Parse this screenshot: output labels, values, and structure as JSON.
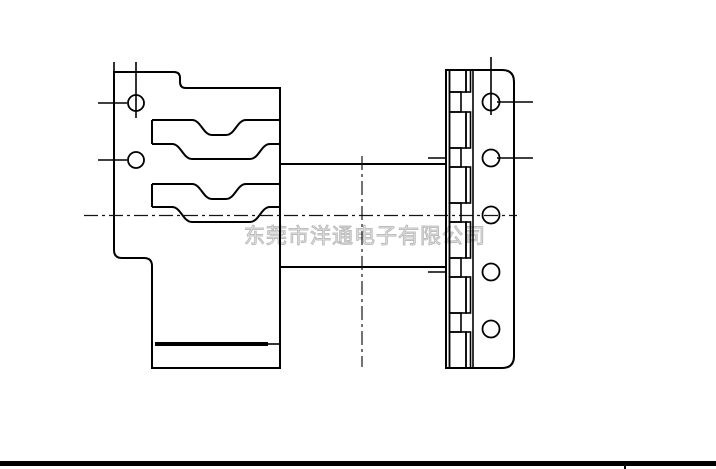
{
  "page": {
    "width": 716,
    "height": 469,
    "background_color": "#ffffff"
  },
  "watermark": {
    "text": "东莞市洋通电子有限公司",
    "color": "#bdbdbd"
  },
  "drawing": {
    "line_color": "#000000",
    "centerline_color": "#141414",
    "left_flange_hole_count": 2,
    "right_flange_hole_count": 5
  },
  "bottom_bar": {
    "color": "#000000"
  }
}
